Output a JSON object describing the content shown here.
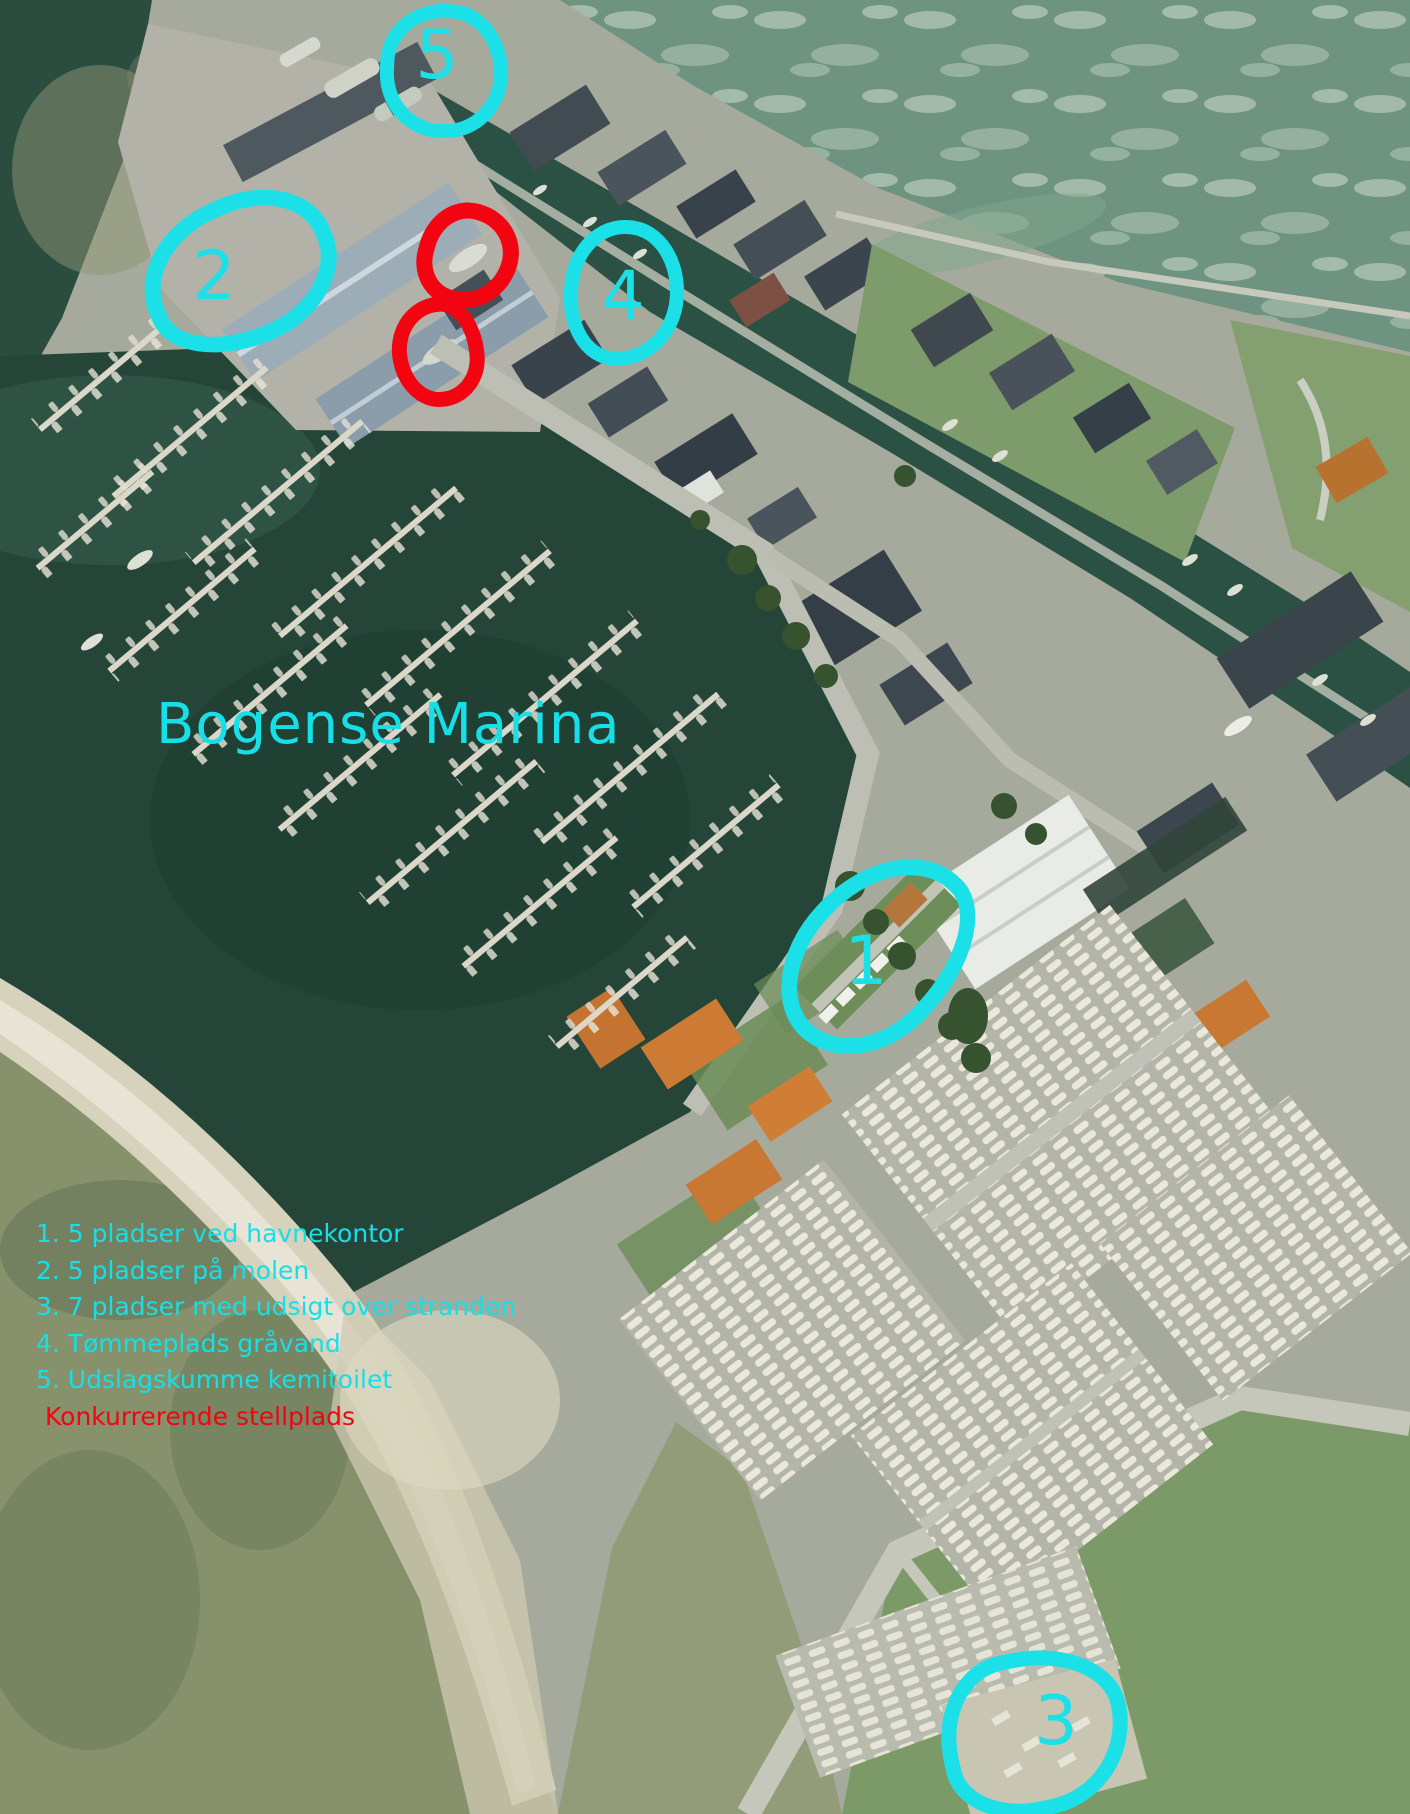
{
  "type": "annotated-aerial-map",
  "title": "Bogense Marina",
  "legend": {
    "items": [
      "1. 5 pladser ved havnekontor",
      "2. 5 pladser på molen",
      "3. 7 pladser med udsigt over stranden",
      "4. Tømmeplads gråvand",
      "5. Udslagskumme kemitoilet"
    ],
    "note": "Konkurrerende stellplads"
  },
  "markers": [
    {
      "label": "1"
    },
    {
      "label": "2"
    },
    {
      "label": "3"
    },
    {
      "label": "4"
    },
    {
      "label": "5"
    }
  ],
  "competitor_markers_count": 2,
  "colors": {
    "marker_highlight": "#1ce0e8",
    "marker_competitor": "#f20410",
    "title_text": "#17dfe8"
  }
}
